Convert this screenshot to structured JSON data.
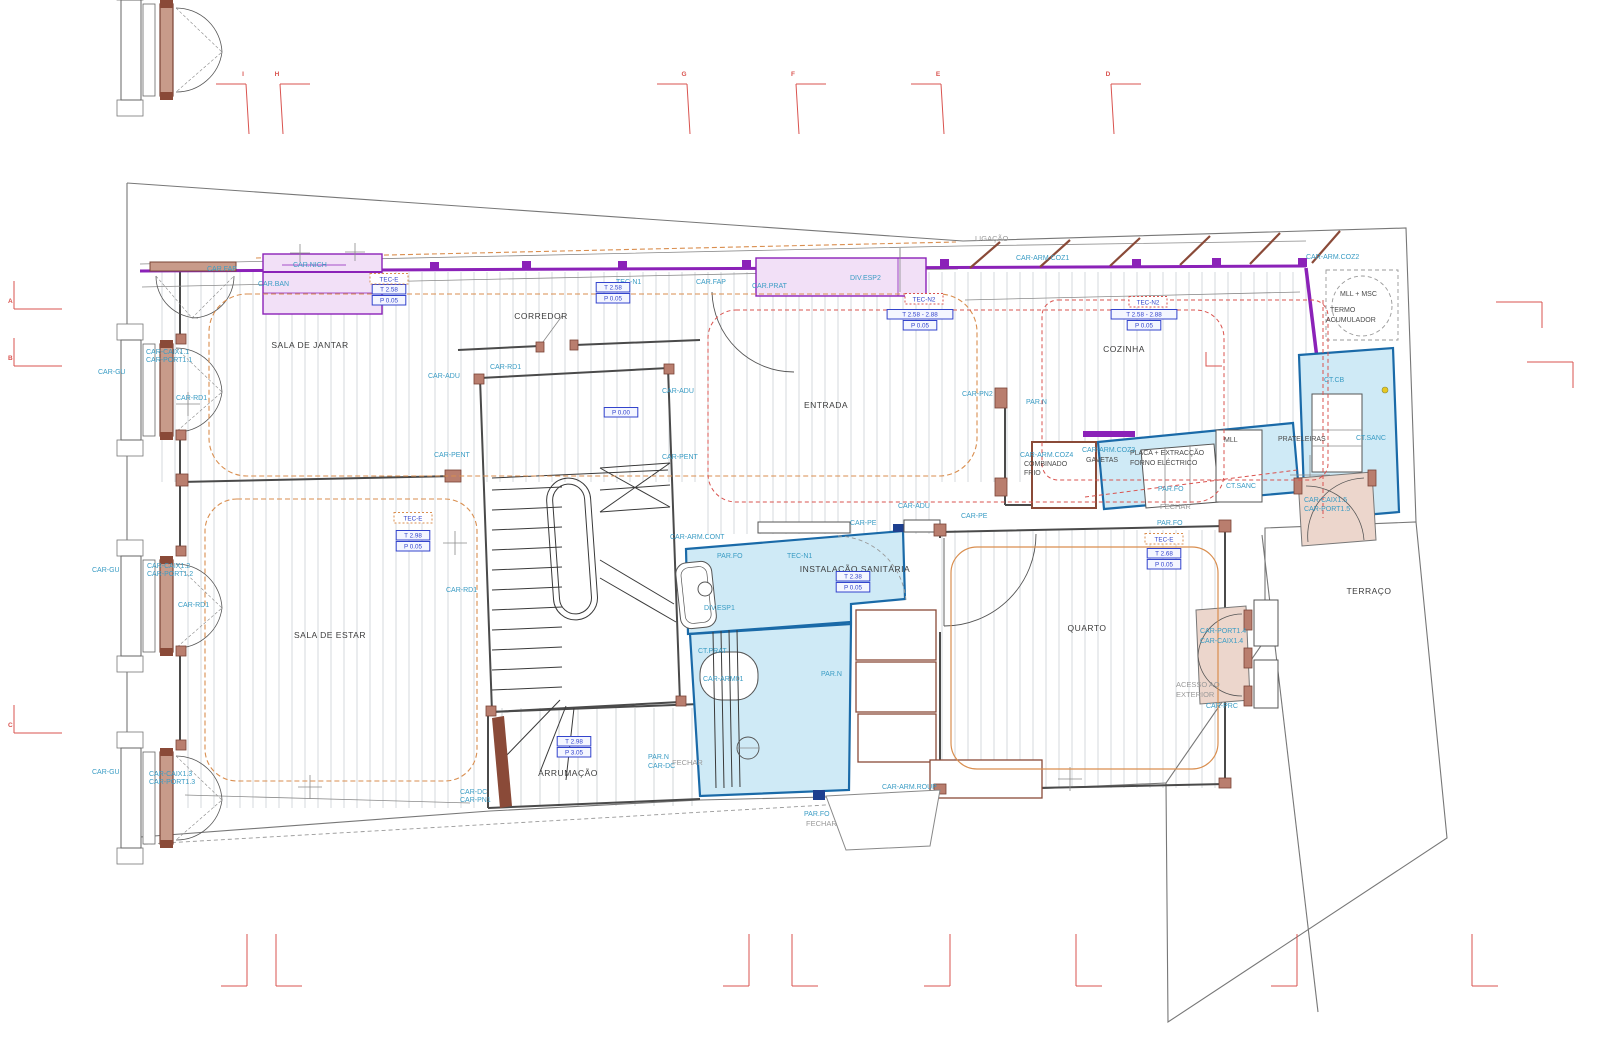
{
  "document": {
    "type": "architectural-floor-plan",
    "language": "pt"
  },
  "colors": {
    "annotation_blue": "#3a9cc4",
    "value_box_blue": "#3344cc",
    "wall_purple": "#8b22b8",
    "fill_pink": "#f2e0f7",
    "fill_cyan": "#cfeaf6",
    "cyan_border": "#1a6aa8",
    "wood_brown": "#b97e6e",
    "ceiling_orange": "#d98e4f",
    "grid_red": "#d9534f",
    "text_gray": "#9a9a9a",
    "text_black": "#3c3c3c"
  },
  "rooms": [
    {
      "t": "SALA DE JANTAR",
      "x": 310,
      "y": 348
    },
    {
      "t": "CORREDOR",
      "x": 541,
      "y": 319
    },
    {
      "t": "ENTRADA",
      "x": 826,
      "y": 408
    },
    {
      "t": "COZINHA",
      "x": 1124,
      "y": 352
    },
    {
      "t": "SALA DE ESTAR",
      "x": 330,
      "y": 638
    },
    {
      "t": "INSTALAÇÃO SANITÁRIA",
      "x": 855,
      "y": 572
    },
    {
      "t": "QUARTO",
      "x": 1087,
      "y": 631
    },
    {
      "t": "ARRUMAÇÃO",
      "x": 568,
      "y": 776
    },
    {
      "t": "TERRAÇO",
      "x": 1369,
      "y": 594
    }
  ],
  "labels": [
    {
      "t": "CAR.FAP",
      "x": 207,
      "y": 271,
      "c": "b"
    },
    {
      "t": "CAR.BAN",
      "x": 258,
      "y": 286,
      "c": "b"
    },
    {
      "t": "CAR.NICH",
      "x": 293,
      "y": 267,
      "c": "b"
    },
    {
      "t": "TEC-N1",
      "x": 616,
      "y": 284,
      "c": "b"
    },
    {
      "t": "CAR.FAP",
      "x": 696,
      "y": 284,
      "c": "b"
    },
    {
      "t": "CAR.PRAT",
      "x": 752,
      "y": 288,
      "c": "b"
    },
    {
      "t": "DIV.ESP2",
      "x": 850,
      "y": 280,
      "c": "b"
    },
    {
      "t": "CAR-ARM.COZ1",
      "x": 1016,
      "y": 260,
      "c": "b"
    },
    {
      "t": "CAR-ARM.COZ2",
      "x": 1306,
      "y": 259,
      "c": "b"
    },
    {
      "t": "CAR-CAIX1.1",
      "x": 146,
      "y": 354,
      "c": "b"
    },
    {
      "t": "CAR-PORT1.1",
      "x": 146,
      "y": 362,
      "c": "b"
    },
    {
      "t": "CAR-GU",
      "x": 98,
      "y": 374,
      "c": "b"
    },
    {
      "t": "CAR-RD1",
      "x": 176,
      "y": 400,
      "c": "b"
    },
    {
      "t": "CAR-ADU",
      "x": 428,
      "y": 378,
      "c": "b"
    },
    {
      "t": "CAR-RD1",
      "x": 490,
      "y": 369,
      "c": "b"
    },
    {
      "t": "CAR-ADU",
      "x": 662,
      "y": 393,
      "c": "b"
    },
    {
      "t": "CAR-PENT",
      "x": 434,
      "y": 457,
      "c": "b"
    },
    {
      "t": "CAR-PENT",
      "x": 662,
      "y": 459,
      "c": "b"
    },
    {
      "t": "CAR-PN2",
      "x": 962,
      "y": 396,
      "c": "b"
    },
    {
      "t": "PAR.N",
      "x": 1026,
      "y": 404,
      "c": "b"
    },
    {
      "t": "CAR-ADU",
      "x": 898,
      "y": 508,
      "c": "b"
    },
    {
      "t": "CAR-PE",
      "x": 850,
      "y": 525,
      "c": "b"
    },
    {
      "t": "CAR-PE",
      "x": 961,
      "y": 518,
      "c": "b"
    },
    {
      "t": "CAR-ARM.CONT",
      "x": 670,
      "y": 539,
      "c": "b"
    },
    {
      "t": "PAR.FO",
      "x": 717,
      "y": 558,
      "c": "b"
    },
    {
      "t": "TEC-N1",
      "x": 787,
      "y": 558,
      "c": "b"
    },
    {
      "t": "DIV.ESP1",
      "x": 704,
      "y": 610,
      "c": "b"
    },
    {
      "t": "CT.PRAT",
      "x": 698,
      "y": 653,
      "c": "b"
    },
    {
      "t": "CAR-ARM01",
      "x": 703,
      "y": 681,
      "c": "b"
    },
    {
      "t": "PAR.N",
      "x": 821,
      "y": 676,
      "c": "b"
    },
    {
      "t": "CAR-ARM.COZ4",
      "x": 1020,
      "y": 457,
      "c": "b"
    },
    {
      "t": "CAR-ARM.COZ3",
      "x": 1082,
      "y": 452,
      "c": "b"
    },
    {
      "t": "PAR.FO",
      "x": 1158,
      "y": 491,
      "c": "b"
    },
    {
      "t": "CT.SANC",
      "x": 1226,
      "y": 488,
      "c": "b"
    },
    {
      "t": "CT.CB",
      "x": 1324,
      "y": 382,
      "c": "b"
    },
    {
      "t": "CT.SANC",
      "x": 1356,
      "y": 440,
      "c": "b"
    },
    {
      "t": "CAR-CAIX1.5",
      "x": 1304,
      "y": 502,
      "c": "b"
    },
    {
      "t": "CAR-PORT1.5",
      "x": 1304,
      "y": 511,
      "c": "b"
    },
    {
      "t": "PAR.FO",
      "x": 1157,
      "y": 525,
      "c": "b"
    },
    {
      "t": "CAR-PORT1.4",
      "x": 1200,
      "y": 633,
      "c": "b"
    },
    {
      "t": "CAR-CAIX1.4",
      "x": 1200,
      "y": 643,
      "c": "b"
    },
    {
      "t": "CAR-PRC",
      "x": 1206,
      "y": 708,
      "c": "b"
    },
    {
      "t": "CAR-GU",
      "x": 92,
      "y": 572,
      "c": "b"
    },
    {
      "t": "CAR-CAIX1.2",
      "x": 147,
      "y": 568,
      "c": "b"
    },
    {
      "t": "CAR-PORT1.2",
      "x": 147,
      "y": 576,
      "c": "b"
    },
    {
      "t": "CAR-RD1",
      "x": 178,
      "y": 607,
      "c": "b"
    },
    {
      "t": "CAR-RD1",
      "x": 446,
      "y": 592,
      "c": "b"
    },
    {
      "t": "CAR-GU",
      "x": 92,
      "y": 774,
      "c": "b"
    },
    {
      "t": "CAR-CAIX1.3",
      "x": 149,
      "y": 776,
      "c": "b"
    },
    {
      "t": "CAR-PORT1.3",
      "x": 149,
      "y": 784,
      "c": "b"
    },
    {
      "t": "CAR-DC",
      "x": 460,
      "y": 794,
      "c": "b"
    },
    {
      "t": "CAR-PN1",
      "x": 460,
      "y": 802,
      "c": "b"
    },
    {
      "t": "PAR.N",
      "x": 648,
      "y": 759,
      "c": "b"
    },
    {
      "t": "CAR-DC",
      "x": 648,
      "y": 768,
      "c": "b"
    },
    {
      "t": "PAR.FO",
      "x": 804,
      "y": 816,
      "c": "b"
    },
    {
      "t": "CAR-ARM.ROUP",
      "x": 882,
      "y": 789,
      "c": "b"
    },
    {
      "t": "MLL + MSC",
      "x": 1340,
      "y": 296,
      "c": "k"
    },
    {
      "t": "TERMO",
      "x": 1330,
      "y": 312,
      "c": "k"
    },
    {
      "t": "ACUMULADOR",
      "x": 1326,
      "y": 322,
      "c": "k"
    },
    {
      "t": "COMBINADO",
      "x": 1024,
      "y": 466,
      "c": "k"
    },
    {
      "t": "FRIO",
      "x": 1024,
      "y": 475,
      "c": "k"
    },
    {
      "t": "GAVETAS",
      "x": 1086,
      "y": 462,
      "c": "k"
    },
    {
      "t": "PLACA + EXTRACÇÃO",
      "x": 1130,
      "y": 455,
      "c": "k"
    },
    {
      "t": "FORNO ELÉCTRICO",
      "x": 1130,
      "y": 465,
      "c": "k"
    },
    {
      "t": "MLL",
      "x": 1224,
      "y": 442,
      "c": "k"
    },
    {
      "t": "PRATELEIRAS",
      "x": 1278,
      "y": 441,
      "c": "k"
    },
    {
      "t": "LIGAÇÃO",
      "x": 975,
      "y": 241,
      "c": "g"
    },
    {
      "t": "FECHAR",
      "x": 1160,
      "y": 509,
      "c": "g"
    },
    {
      "t": "ACESSO AO",
      "x": 1176,
      "y": 687,
      "c": "g"
    },
    {
      "t": "EXTERIOR",
      "x": 1176,
      "y": 697,
      "c": "g"
    },
    {
      "t": "FECHAR",
      "x": 672,
      "y": 765,
      "c": "g"
    },
    {
      "t": "FECHAR",
      "x": 806,
      "y": 826,
      "c": "g"
    }
  ],
  "value_boxes": [
    {
      "x": 389,
      "y": 292,
      "lines": [
        "T 2.58",
        "P 0.05"
      ]
    },
    {
      "x": 613,
      "y": 290,
      "lines": [
        "T 2.58",
        "P 0.05"
      ]
    },
    {
      "x": 920,
      "y": 317,
      "lines": [
        "T 2.58 - 2.88",
        "P 0.05"
      ]
    },
    {
      "x": 1144,
      "y": 317,
      "lines": [
        "T 2.58 - 2.88",
        "P 0.05"
      ]
    },
    {
      "x": 621,
      "y": 415,
      "lines": [
        "P 0.00"
      ]
    },
    {
      "x": 413,
      "y": 538,
      "lines": [
        "T 2.98",
        "P 0.05"
      ]
    },
    {
      "x": 853,
      "y": 579,
      "lines": [
        "T 2.38",
        "P 0.05"
      ]
    },
    {
      "x": 1164,
      "y": 556,
      "lines": [
        "T 2.68",
        "P 0.05"
      ]
    },
    {
      "x": 574,
      "y": 744,
      "lines": [
        "T 2.98",
        "P 3.05"
      ]
    }
  ],
  "tec_boxes": [
    {
      "x": 389,
      "y": 281,
      "t": "TEC-E",
      "s": "o"
    },
    {
      "x": 413,
      "y": 520,
      "t": "TEC-E",
      "s": "o"
    },
    {
      "x": 1164,
      "y": 541,
      "t": "TEC-E",
      "s": "o"
    },
    {
      "x": 924,
      "y": 301,
      "t": "TEC-N2",
      "s": "r"
    },
    {
      "x": 1148,
      "y": 304,
      "t": "TEC-N2",
      "s": "r"
    }
  ],
  "grid": {
    "top": [
      {
        "l": "I",
        "x": 243
      },
      {
        "l": "H",
        "x": 277
      },
      {
        "l": "G",
        "x": 684
      },
      {
        "l": "F",
        "x": 793
      },
      {
        "l": "E",
        "x": 938
      },
      {
        "l": "D",
        "x": 1108
      }
    ],
    "left": [
      {
        "l": "A",
        "y": 303
      },
      {
        "l": "B",
        "y": 360
      },
      {
        "l": "C",
        "y": 727
      }
    ],
    "bottom": [
      247,
      276,
      749,
      792,
      950,
      1076,
      1297,
      1472
    ],
    "right": [
      {
        "x": 1496,
        "y": 302
      },
      {
        "x": 1527,
        "y": 362
      }
    ]
  }
}
